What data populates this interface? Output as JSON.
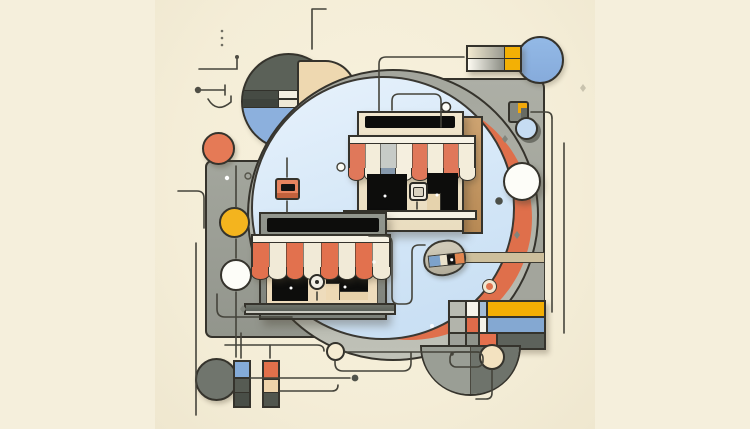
{
  "meta": {
    "title": "Abstract storefront illustration",
    "description": "Flat geometric illustration on a cream background: two storefronts with red-and-white scalloped awnings sit on overlapping gray panels and a large light-blue circle ringed in gray with an orange crescent; decorative circles, a Mondrian-style color grid, gradient cards, bars and thin connector lines surround them.",
    "canvas": {
      "width": 750,
      "height": 429
    }
  },
  "palette": {
    "outline": "#35332c",
    "bg": "#f5efdc",
    "black": "#0d0d0c",
    "blue": "#8cb0dd",
    "blueLight": "#d6e7f7",
    "salmon": "#e0744f",
    "salmonDeep": "#df6f4b",
    "salmonSoft": "#e8845f",
    "yellow": "#f3b005",
    "yellowDeep": "#f2a90a",
    "yellowCirc": "#f4b41e",
    "cream": "#f1ead7",
    "tan": "#eed8b0",
    "tanDeep": "#c69c6a",
    "panelGray": "#9b9e95",
    "darkGray": "#6e736b",
    "white": "#fdfdf8"
  },
  "scene": {
    "storefront_upper": {
      "facade_color": "#f0e5cc",
      "sign_color": "#0d0d0c",
      "awning": {
        "slope": [
          "#e0785a",
          "#f3edda",
          "#c7cbc7",
          "#f5efdf",
          "#e0785a",
          "#f3edda",
          "#e0785a",
          "#f3edda"
        ],
        "scallops": [
          "#e0785a",
          "#f3edda",
          "#8699ad",
          "#f5efdf",
          "#e0785a",
          "#f3edda",
          "#e0785a",
          "#f3edda"
        ]
      }
    },
    "storefront_lower": {
      "frame_color": "#8b8f87",
      "sign_color": "#0d0d0c",
      "awning": {
        "slope": [
          "#e2714e",
          "#f1ead7",
          "#e2714e",
          "#f1ead7",
          "#e2714e",
          "#f1ead7",
          "#e2714e",
          "#f1ead7"
        ],
        "scallops": [
          "#e2714e",
          "#f1ead7",
          "#e2714e",
          "#f1ead7",
          "#e2714e",
          "#f1ead7",
          "#e2714e",
          "#f1ead7"
        ]
      }
    },
    "mondrian": {
      "rows": [
        [
          {
            "c": "#b9bbb1",
            "s": 15
          },
          {
            "c": "#f7f4ea",
            "s": 11
          },
          {
            "c": "#a3bcd8",
            "s": 6
          },
          {
            "c": "#f3ae04",
            "s": 56
          }
        ],
        [
          {
            "c": "#b2b4ab",
            "s": 15
          },
          {
            "c": "#e06b4a",
            "s": 11
          },
          {
            "c": "#f6f3e9",
            "s": 6
          },
          {
            "c": "#84a8d2",
            "s": 56
          }
        ],
        [
          {
            "c": "#9da099",
            "s": 15
          },
          {
            "c": "#8f938b",
            "s": 11
          },
          {
            "c": "#e4704d",
            "s": 16
          },
          {
            "c": "#5d625b",
            "s": 46
          }
        ]
      ]
    },
    "bars": {
      "bar1": [
        {
          "c": "#84abd8",
          "s": 15
        },
        {
          "c": "#565b53",
          "s": 13
        },
        {
          "c": "#494e47",
          "s": 13
        }
      ],
      "bar2": [
        {
          "c": "#e2704b",
          "s": 16
        },
        {
          "c": "#eed3aa",
          "s": 12
        },
        {
          "c": "#51564e",
          "s": 13
        }
      ]
    },
    "badge_stripe": [
      "#7da2cb",
      "#ebe2cb",
      "#171614",
      "#e2854e"
    ],
    "gradient_card": {
      "row_gradients": [
        "#f2e9cf → #8e9089",
        "#fdfbf2 → #787b72"
      ],
      "end_color": "#f3b005"
    }
  }
}
